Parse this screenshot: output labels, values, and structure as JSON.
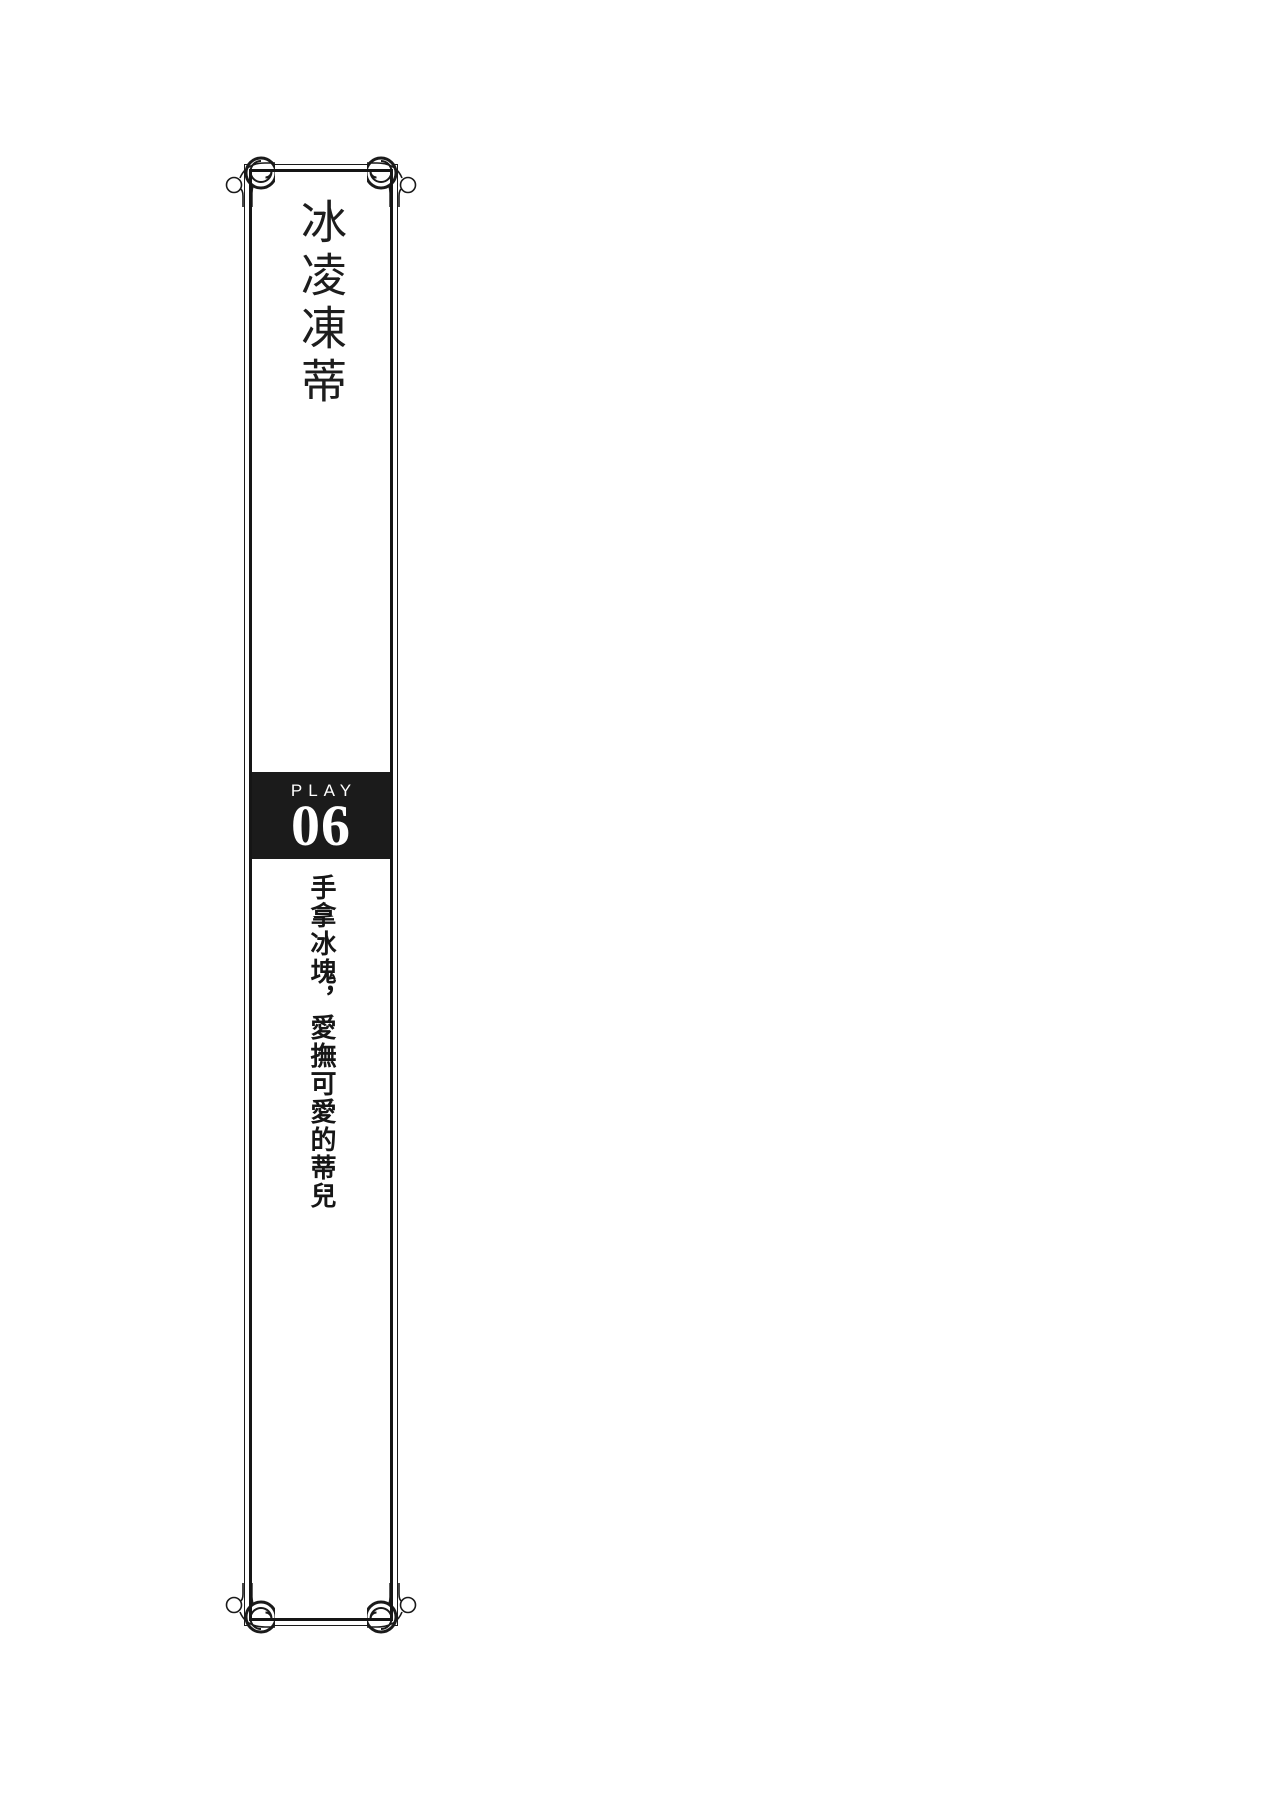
{
  "panel": {
    "title": "冰凌凍蒂",
    "play_label": "PLAY",
    "play_number": "06",
    "subtitle": "手拿冰塊，愛撫可愛的蒂兒"
  },
  "colors": {
    "paper": "#ffffff",
    "ink": "#1a1a1a",
    "number_box_bg": "#1b1b1b",
    "number_box_text": "#ffffff"
  }
}
